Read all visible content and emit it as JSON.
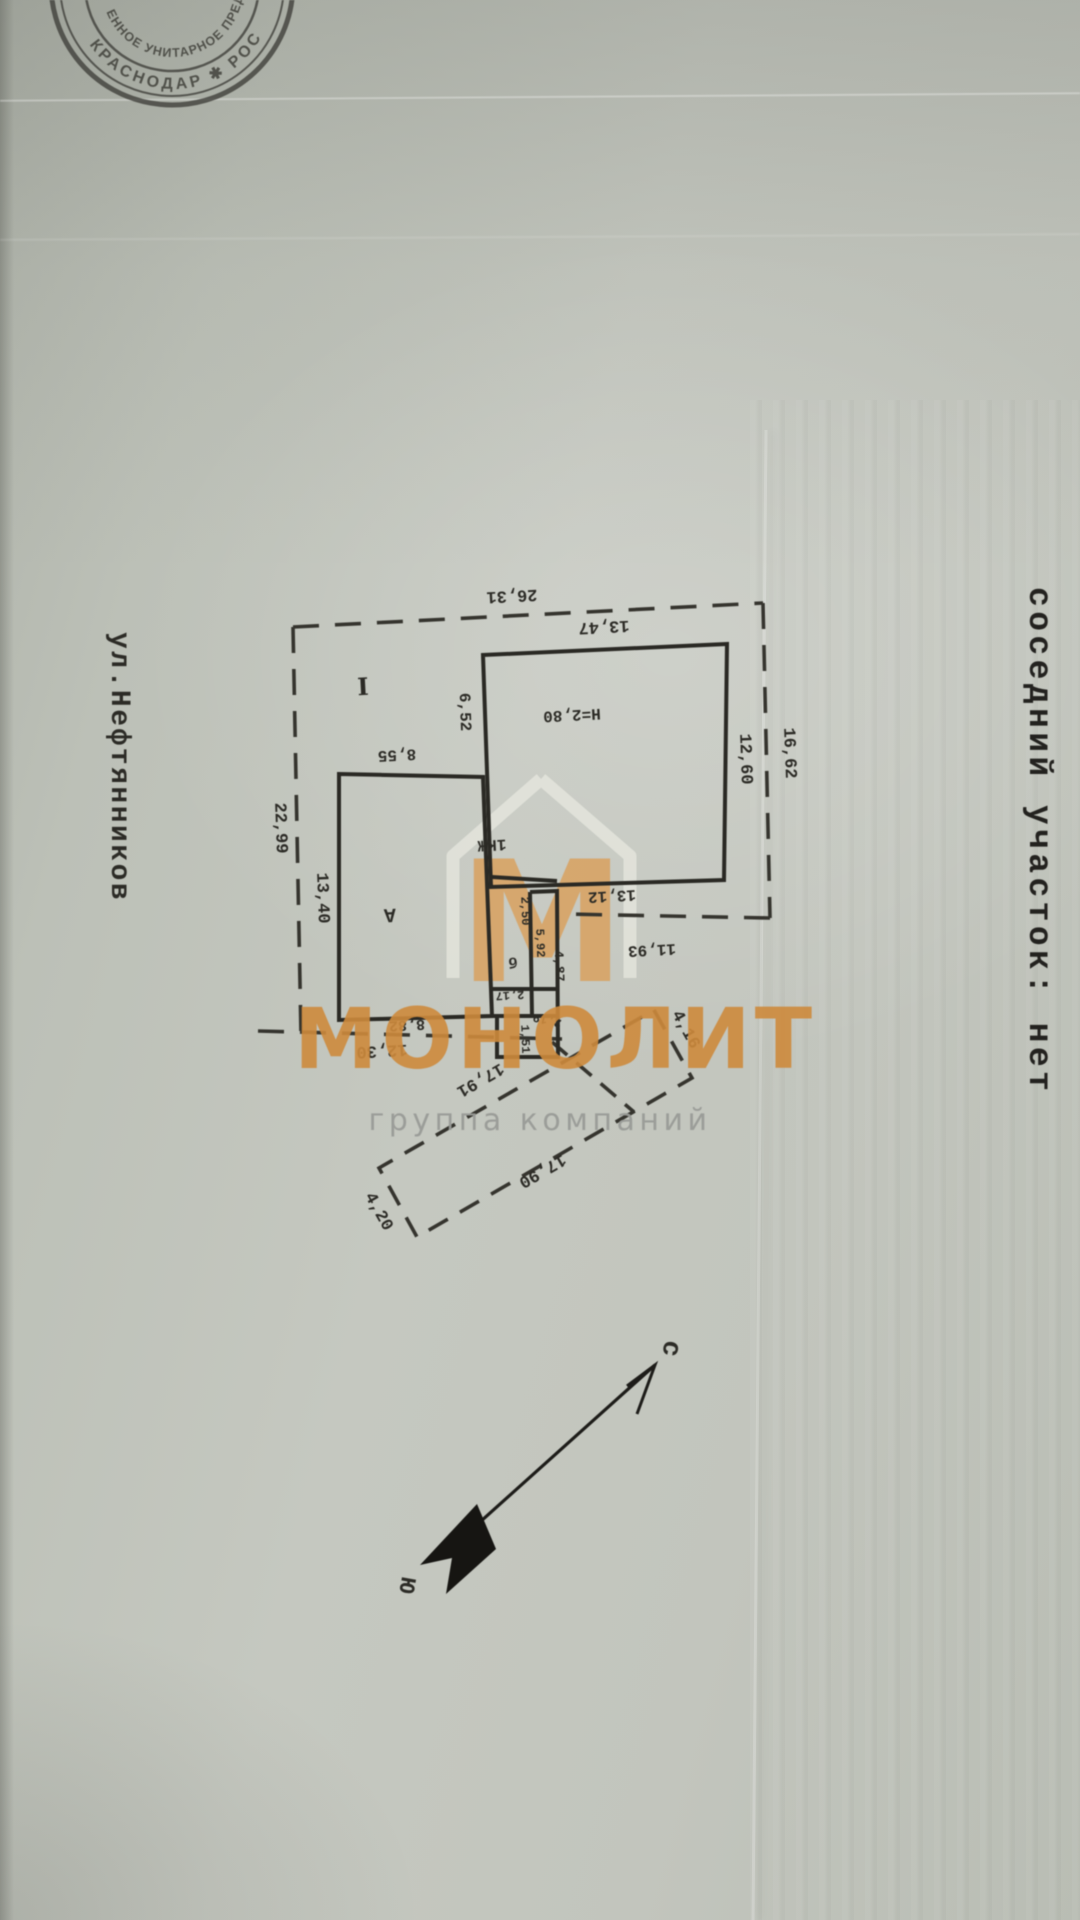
{
  "stamp": {
    "outer_text": "КРАСНОДАР ✱ РОС",
    "inner_text": "ЕННОЕ УНИТАРНОЕ ПРЕД",
    "ink_color": "#3f3f39"
  },
  "watermark": {
    "logo_letter": "М",
    "title": "МОНОЛИТ",
    "subtitle": "группа компаний",
    "orange": "#cd8a40",
    "logo_orange": "#d7a express15f",
    "gray": "#999b97"
  },
  "compass": {
    "north_label": "с",
    "south_label": "ю"
  },
  "side_texts": {
    "street": "ул.Нефтянников",
    "neighbor": "соседний участок:  нет"
  },
  "plan": {
    "building_label": "1КЖ",
    "height_label": "Н=2,80",
    "ink": "#2c2b26",
    "labels": [
      {
        "t": "26,31",
        "x": 512,
        "y": 597,
        "r": 177,
        "fs": 17,
        "f": "mono"
      },
      {
        "t": "13,47",
        "x": 604,
        "y": 628,
        "r": 177,
        "fs": 17,
        "f": "mono"
      },
      {
        "t": "16,62",
        "x": 791,
        "y": 753,
        "r": 88,
        "fs": 17,
        "f": "mono"
      },
      {
        "t": "12,60",
        "x": 747,
        "y": 759,
        "r": 88,
        "fs": 17,
        "f": "mono"
      },
      {
        "t": "Н=2,80",
        "x": 572,
        "y": 716,
        "r": 177,
        "fs": 16,
        "f": "mono"
      },
      {
        "t": "6,52",
        "x": 466,
        "y": 712,
        "r": 88,
        "fs": 16,
        "f": "mono"
      },
      {
        "t": "8,55",
        "x": 397,
        "y": 756,
        "r": 177,
        "fs": 16,
        "f": "mono"
      },
      {
        "t": "22,99",
        "x": 282,
        "y": 828,
        "r": 88,
        "fs": 17,
        "f": "mono"
      },
      {
        "t": "13,40",
        "x": 324,
        "y": 898,
        "r": 88,
        "fs": 17,
        "f": "mono"
      },
      {
        "t": "I",
        "x": 363,
        "y": 686,
        "r": 177,
        "fs": 24,
        "f": "serif"
      },
      {
        "t": "А",
        "x": 390,
        "y": 916,
        "r": 177,
        "fs": 20,
        "f": "mono"
      },
      {
        "t": "1КЖ",
        "x": 492,
        "y": 846,
        "r": 177,
        "fs": 16,
        "f": "mono"
      },
      {
        "t": "13,12",
        "x": 612,
        "y": 897,
        "r": 177,
        "fs": 16,
        "f": "mono"
      },
      {
        "t": "11,93",
        "x": 652,
        "y": 951,
        "r": 177,
        "fs": 16,
        "f": "mono"
      },
      {
        "t": "2,50",
        "x": 526,
        "y": 911,
        "r": 88,
        "fs": 12,
        "f": "mono"
      },
      {
        "t": "5,92",
        "x": 541,
        "y": 943,
        "r": 88,
        "fs": 12,
        "f": "mono"
      },
      {
        "t": "4,87",
        "x": 560,
        "y": 966,
        "r": 88,
        "fs": 13,
        "f": "mono"
      },
      {
        "t": "б",
        "x": 513,
        "y": 963,
        "r": 177,
        "fs": 15,
        "f": "mono"
      },
      {
        "t": "2,17",
        "x": 510,
        "y": 996,
        "r": 177,
        "fs": 12,
        "f": "mono"
      },
      {
        "t": "2,19",
        "x": 547,
        "y": 1021,
        "r": 193,
        "fs": 12,
        "f": "mono"
      },
      {
        "t": "1,51",
        "x": 526,
        "y": 1039,
        "r": 88,
        "fs": 12,
        "f": "mono"
      },
      {
        "t": "8,82",
        "x": 407,
        "y": 1026,
        "r": 177,
        "fs": 15,
        "f": "mono"
      },
      {
        "t": "12,30",
        "x": 382,
        "y": 1052,
        "r": 177,
        "fs": 17,
        "f": "mono"
      },
      {
        "t": "17,91",
        "x": 481,
        "y": 1081,
        "r": 150,
        "fs": 17,
        "f": "mono"
      },
      {
        "t": "17,90",
        "x": 543,
        "y": 1172,
        "r": 150,
        "fs": 17,
        "f": "mono"
      },
      {
        "t": "4,16",
        "x": 687,
        "y": 1029,
        "r": 61,
        "fs": 17,
        "f": "mono"
      },
      {
        "t": "4,20",
        "x": 380,
        "y": 1211,
        "r": 61,
        "fs": 17,
        "f": "mono"
      },
      {
        "t": "с",
        "x": 673,
        "y": 1349,
        "r": 100,
        "fs": 27,
        "f": "mono"
      },
      {
        "t": "ю",
        "x": 410,
        "y": 1586,
        "r": 100,
        "fs": 27,
        "f": "mono"
      },
      {
        "t": "ул.Нефтянников",
        "x": 112,
        "y": 632,
        "r": 90,
        "fs": 28,
        "f": "mono",
        "ls": 2.5,
        "anchor": "start"
      },
      {
        "t": "соседний участок:  нет",
        "x": 1030,
        "y": 587,
        "r": 90,
        "fs": 33,
        "f": "mono",
        "ls": 4.4,
        "anchor": "start",
        "c": "#23221f"
      }
    ]
  }
}
